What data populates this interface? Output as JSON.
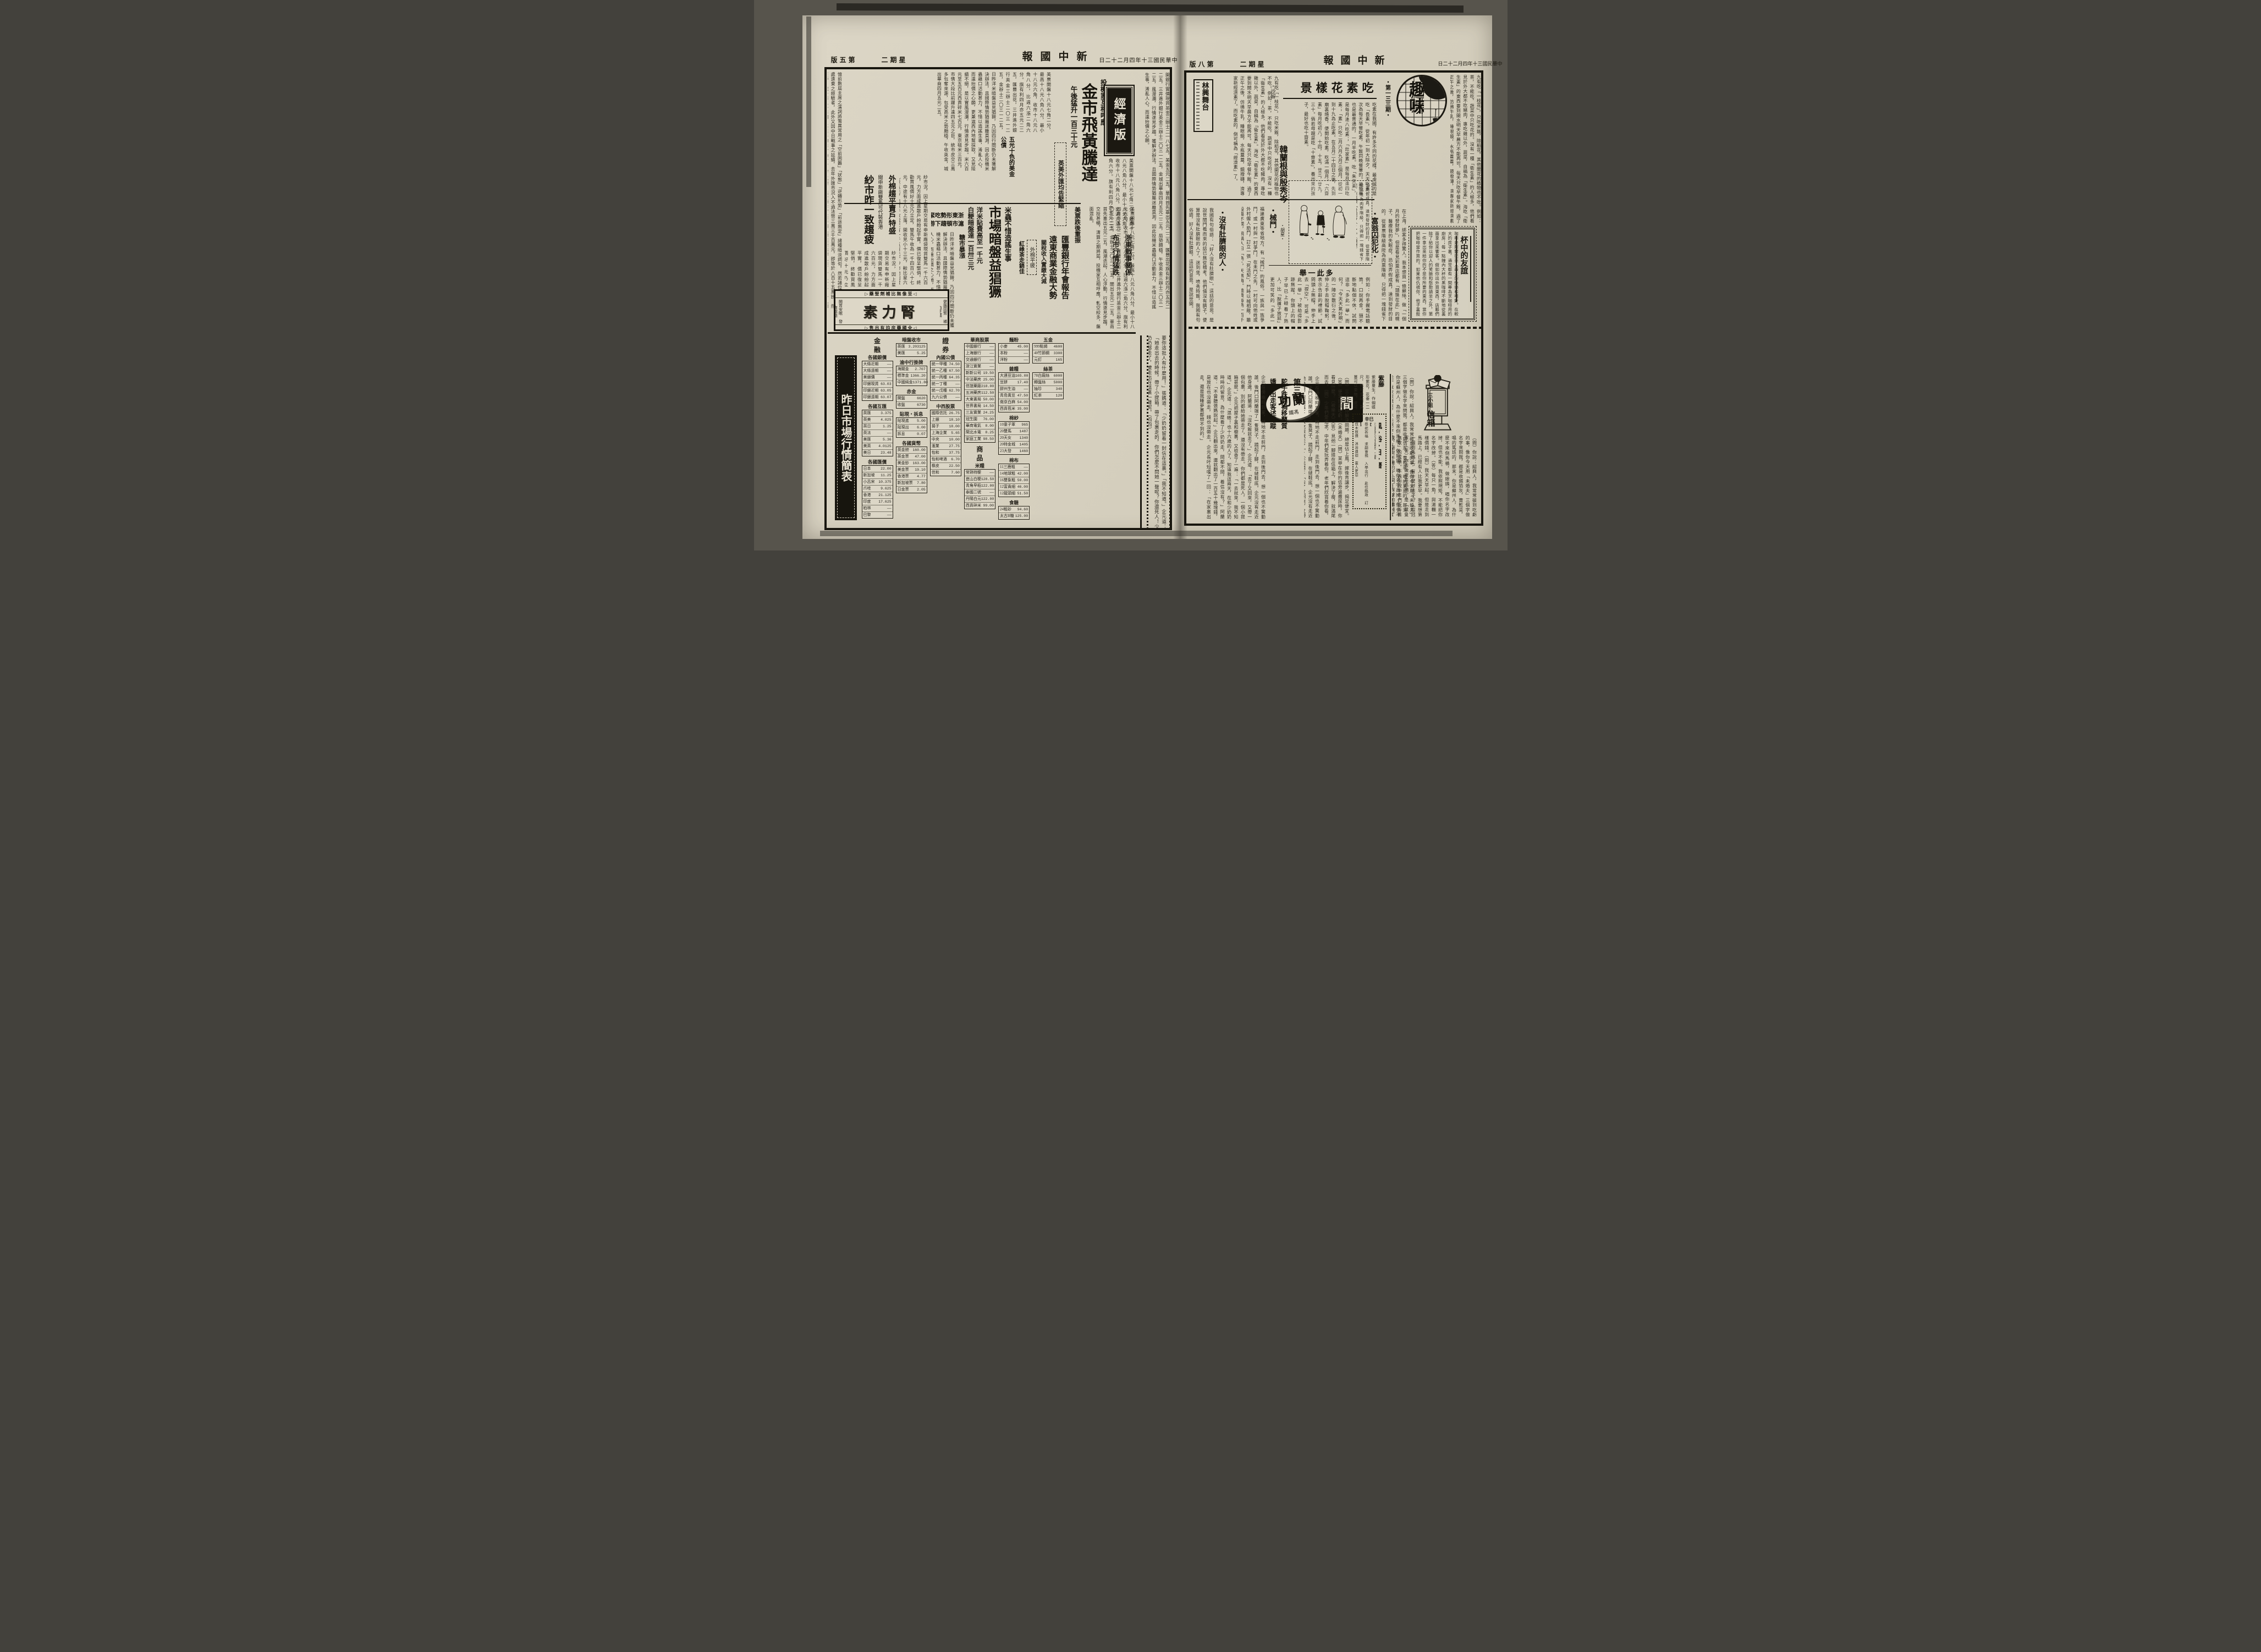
{
  "canvas": {
    "bg": "#57544c",
    "paper": "#d8d2c2",
    "ink": "#1b1810"
  },
  "page5": {
    "header": {
      "page_label": "第五版",
      "weekday": "星期二",
      "masthead": "新中國報",
      "date": "中華民國三十年四月二十二日"
    },
    "seal": "經濟版",
    "lead": {
      "kicker": "投機家互相呼應",
      "headline": "金市飛黃騰達",
      "subhead": "午後猛升一百三十元",
      "fx_box": "英美外匯均告緊縮",
      "war1": "浙東戰事關係",
      "war2": "布市行情猛跌",
      "bonds": "五光十色的美金公債"
    },
    "rice": {
      "kicker": "米蟲不惜造謠生事",
      "headline": "市場暗盤益猖獗",
      "sub1": "洋米貼費高至一千元",
      "sub2": "白粳暗盤達一百卅三元",
      "us": "美票跌後重振",
      "zj1": "浙東形勢吃緊",
      "zj2": "滬市頓趨下游",
      "sugar": "糖市暴漲"
    },
    "hsbc": {
      "l1": "匯豐銀行年會報告",
      "l2": "遠東商業金融大勢",
      "tariff": "關稅收入實繳大減",
      "cotton_flat": "外棉平疲",
      "tea": "紅綠茶走銷佳",
      "yarn_kicker": "聞申新廠雙馬可代裝香港",
      "yarn": "紗市昨一致趨疲",
      "cotton2": "外棉趨平賣戶特盛"
    },
    "body": {
      "a": "日昨洋米暗盤益見猖獗，乃因四行間斷仍未獲解決辦法，且國際情勢猶屬迷離莫測，因此投機米蟲藉口活動甚力，不惜以造謠生事，淆亂人心，而達抬價之心願，更兼滬西內地幫採取，又見陸續不絕，是以實風漫瀰，行情遂見步趨。米六百元至五百元西貢碎米七百元，東京砠米三百元，市情大段比前躍升達四五元之巨，統市皮交三萬多包奪來源，包受高米之勢頗穩，午收英金，城出華商四月五元二五。",
      "b": "美票開盤十八元七角二分，最高十八元八角八分，最小十八元六角，收市十八元八角八分，比週六漲二角六分。旗有利四月亦五元二二五，匯豐出花，三井進外銀行英金三辦士二〇三一二五，金辦士二〇三一二五，開出五元二二五，華商首先塞出五元二五，風潮迭起，人心浮動，行情逐見步趨，交投甚暢，清算之期將屆，投機家互相呼應，軋空絞多，盤面混亂。",
      "c": "憶前數屆主席之演詞將鷩異常用之「空前困難」「狀態」「逆轉形勢」「前途無定」諸種暗淡詞句，然若諸位有數年居處遠東之經驗者，此外又因中日戰事之延續，去年外匯市況入不過法幣三萬三千百萬元，卽等於八百十五萬鎊，然在中日戰爭前之十年間，每年平均未少過一千九百萬鎊，無從轉好。該年輸入總值僅佔總入口百分之一三，一九四〇年竟增至百分之五一，在出口方面又被「專利權」「統制法令」所影響，遂致對於貿易平衡，發生嚴重之後果。",
      "d": "開銀行實價現貨英金三辦士二一八七五，美金五元二五，華商首先塞出五元二二五，匯豐出花旗有利四月亦五元二二五，三井進外銀行英金三辦士二〇三一二五，金城出華商四月五元二二五，局勢頗穩，午收英金三辦士二〇三一二五，風漫瀰，行情遂見步趨。獲解決辦法，且國際情勢猶屬迷離莫測，因此投機米蟲藉口活動甚力，不惜以造謠生事，淆亂人心，而達抬價之心願。",
      "e": "紗市況，因上星期交易有申新廠袋現貨雙馬一千六百元，力方面成進散戶紛紛起平實，價已復呈堅俏，終勸買風價好十元乃立定，雙馬午收為一千四百八十七元，中途有十八元上落，開收見小十三元，較比星六軋跌五元，結果午收成交有一千五百元。紗市始因賣戶匯價乃步落，一時供千六百包，港幫進九百十包，及星六場外計九千二百〇五包，內裝往安南一千包，裝去香港一和樺，新廠成交現貨雙四百七十七元，及同業連五千六百九十五包。"
    },
    "banner": "昨日市場行情簡表",
    "ad": {
      "top": "◁至像無比補劑聖藥▷",
      "name": "腎力素",
      "side_r": "健腦固腎 補血生精",
      "side_l": "開胃安眠 發育滋陰",
      "bottom": "◁全國藥房均有出售▷"
    },
    "serial_tail": "要你這批人有什麼用！」張媽道：「少奶奶留着一封信在這裏。」「我不知道。」企元道：「她走出去的時候，帶了小提箱，帶了包裹走的，你們怎麼不問她一聲呢？你還死人！少奶奶都走了，嬤走出在這裏一聲呢。（四四）",
    "tables": [
      {
        "title": "金　融",
        "sub": "各國銀價",
        "rows": [
          [
            "大條近期",
            "——"
          ],
          [
            "大條遠期",
            "——"
          ],
          [
            "美銀價",
            "——"
          ],
          [
            "印銀現貨",
            "63.03"
          ],
          [
            "印銀近期",
            "63.05"
          ],
          [
            "印銀遠期",
            "63.07"
          ]
        ]
      },
      {
        "sub": "各國互匯",
        "rows": [
          [
            "英匯",
            "3.375"
          ],
          [
            "英美",
            "4.025"
          ],
          [
            "英日",
            "1.25"
          ],
          [
            "英法",
            "——"
          ],
          [
            "美匯",
            "5.36"
          ],
          [
            "美英",
            "4.0125"
          ],
          [
            "美日",
            "23.48"
          ]
        ]
      },
      {
        "sub": "各國匯價",
        "rows": [
          [
            "日本",
            "22.00"
          ],
          [
            "新加坡",
            "11.25"
          ],
          [
            "小呂宋",
            "10.375"
          ],
          [
            "爪哇",
            "9.625"
          ],
          [
            "香港",
            "21.125"
          ],
          [
            "印度",
            "17.625"
          ],
          [
            "柏林",
            "——"
          ],
          [
            "巴黎",
            "——"
          ]
        ]
      },
      {
        "sub": "暗盤收市",
        "rows": [
          [
            "英匯",
            "3.203125"
          ],
          [
            "美匯",
            "5.25"
          ]
        ]
      },
      {
        "sub": "渝中行掛牌",
        "rows": [
          [
            "海關金",
            "2.707"
          ],
          [
            "標準金",
            "1366.20"
          ],
          [
            "中國純金",
            "1371.80"
          ]
        ]
      },
      {
        "sub": "赤金",
        "rows": [
          [
            "開盤",
            "6620"
          ],
          [
            "收盤",
            "6730"
          ]
        ]
      },
      {
        "sub": "貼現・拆息",
        "rows": [
          [
            "貼現進",
            "5.00"
          ],
          [
            "貼現出",
            "6.00"
          ],
          [
            "拆息",
            "0.07"
          ]
        ]
      },
      {
        "sub": "各國貨幣",
        "rows": [
          [
            "英金鎊",
            "160.00"
          ],
          [
            "英金票",
            "47.00"
          ],
          [
            "美金鈔",
            "163.00"
          ],
          [
            "美金票",
            "19.10"
          ],
          [
            "香港票",
            "4.77"
          ],
          [
            "新加坡票",
            "7.80"
          ],
          [
            "日金票",
            "2.05"
          ]
        ]
      },
      {
        "title": "證　券",
        "sub": "內國公債",
        "rows": [
          [
            "統一甲種",
            "74.50"
          ],
          [
            "統一乙種",
            "67.50"
          ],
          [
            "統一丙種",
            "64.35"
          ],
          [
            "統一丁種",
            "——"
          ],
          [
            "統一戊種",
            "62.70"
          ],
          [
            "九六公債",
            "——"
          ]
        ]
      },
      {
        "sub": "中西股票",
        "rows": [
          [
            "國際信託",
            "26.75"
          ],
          [
            "上銀",
            "18.10"
          ],
          [
            "揚子",
            "18.00"
          ],
          [
            "上海企業",
            "5.65"
          ],
          [
            "中央",
            "10.00"
          ],
          [
            "滙業",
            "27.75"
          ],
          [
            "怡和",
            "37.75"
          ],
          [
            "怡和啤酒",
            "6.70"
          ],
          [
            "橡皮",
            "22.50"
          ],
          [
            "信和",
            "7.60"
          ]
        ]
      },
      {
        "sub": "華商股票",
        "rows": [
          [
            "中國銀行",
            "——"
          ],
          [
            "上海銀行",
            "——"
          ],
          [
            "交通銀行",
            "——"
          ],
          [
            "浙江實業",
            "——"
          ],
          [
            "新新公司",
            "19.50"
          ],
          [
            "中法藥房",
            "25.00"
          ],
          [
            "信誼藥廠",
            "218.00"
          ],
          [
            "五洲藥房",
            "112.50"
          ],
          [
            "大東書局",
            "50.00"
          ],
          [
            "世界書局",
            "14.50"
          ],
          [
            "三友實業",
            "24.25"
          ],
          [
            "冠生園",
            "76.00"
          ],
          [
            "華商電氣",
            "8.00"
          ],
          [
            "閘北水電",
            "8.25"
          ],
          [
            "家庭工業",
            "98.50"
          ]
        ]
      },
      {
        "title": "商　品",
        "sub": "米糧",
        "rows": [
          [
            "常熟特粳",
            "——"
          ],
          [
            "崑山白粳",
            "128.50"
          ],
          [
            "青角早稻",
            "122.00"
          ],
          [
            "泰國二號",
            "——"
          ],
          [
            "丹陽白元",
            "122.00"
          ],
          [
            "西貢碎米",
            "99.00"
          ]
        ]
      },
      {
        "sub": "麵粉",
        "rows": [
          [
            "小麥",
            "45.00"
          ],
          [
            "本粉",
            "——"
          ],
          [
            "洋粉",
            "——"
          ]
        ]
      },
      {
        "sub": "雜糧",
        "rows": [
          [
            "大連豆油",
            "165.00"
          ],
          [
            "豆餅",
            "17.40"
          ],
          [
            "膠州生油",
            "——"
          ],
          [
            "青島黃豆",
            "47.50"
          ],
          [
            "南京白麻",
            "54.00"
          ],
          [
            "西貢苞米",
            "35.00"
          ]
        ]
      },
      {
        "sub": "棉紗",
        "rows": [
          [
            "10童子軍",
            "965"
          ],
          [
            "20雙馬",
            "1487"
          ],
          [
            "20天女",
            "1340"
          ],
          [
            "20特金城",
            "1405"
          ],
          [
            "23大發",
            "1460"
          ]
        ]
      },
      {
        "sub": "棉布",
        "rows": [
          [
            "11三鹿粗",
            "——"
          ],
          [
            "14地球粗",
            "42.00"
          ],
          [
            "16雙象粗",
            "50.00"
          ],
          [
            "12富貴細",
            "46.00"
          ],
          [
            "12龍頭細",
            "51.50"
          ]
        ]
      },
      {
        "sub": "食糖",
        "rows": [
          [
            "24粗砂",
            "94.60"
          ],
          [
            "太古B糖",
            "125.00"
          ]
        ]
      },
      {
        "sub": "五金",
        "rows": [
          [
            "999點錫",
            "4600"
          ],
          [
            "40竹節鋼",
            "3300"
          ],
          [
            "元釘",
            "165"
          ]
        ]
      },
      {
        "sub": "絲茶",
        "rows": [
          [
            "78白廠絲",
            "6000"
          ],
          [
            "轉盤絲",
            "5000"
          ],
          [
            "抽珍",
            "340"
          ],
          [
            "紅茶",
            "120"
          ]
        ]
      }
    ]
  },
  "page8": {
    "header": {
      "page_label": "第八版",
      "weekday": "星期二",
      "masthead": "新中國報",
      "date": "中華民國三十年四月二十二日"
    },
    "logo": {
      "name": "趣味",
      "issue": "・第一三三期・"
    },
    "veg": {
      "title": "吃素花樣景",
      "byline": "・沙留"
    },
    "theater": "林興舞台",
    "cartoon": {
      "title": "韓蘭根與殷秀岑",
      "byline": "・胡星・",
      "caption": "怕弄假成真，達到發財的目的，從當票階級高陞為肉票階級，只得把一塊錢省下來，依舊做「丹陽客人」了。（飛瀑）"
    },
    "articles": {
      "fuweng_title": "・富翁囚犯化・",
      "fuweng": "在上海，綁案多得驚人。我本想買一條蘇絲，做「一個月的發財夢」，但是看見彩票店都有「頭獎在此」的幌子，醫療我的失眠症，恐怕弄假成真，達到發財的目的，從當票階級高陞為肉票階級，只得把一塊錢省下來，依舊做「丹陽客人」了。",
      "coffee_title": "杯中的友誼",
      "coffee": "咖啡是阿爾巴亞人最大的快樂和嗜好。在較大的房子裏，通常都有一間專為烹咖啡用的廚房；每一點鐘內大杯的黑咖啡不斷地從裏面拿出來饗客。假如你出外買東西，店夥們除了給你以迎人的笑臉和慇懃請坐之外，第一件拿出來給你的不是你所要的東西，當你把咖啡當作買的。如果他仇視你，他子裏殺死你遠，亦不是他逮。",
      "xiedou_title": "・械鬥・",
      "xiedou": "福建廣東等省地方，有「械鬥」的風俗。一族與一族爭鬥，或一村與一村爭鬥。在未鬥之先，一村可向他姓或外村僱人助鬥，訂立一張「死活契」，鬥時以械相敵，雖殺傷不憫，飛稱人曰「鳥」，天無悔。恤費每鳥一百千文，如鳥糧每隻百文，「某某承雇甚衆」。",
      "duqi_title": "・沒有肚臍眼的人・",
      "duqi": "我國有句俗語：「好人沒有肚臍眼」。這話的意思，是說世間門檻而來的話已無從稽考，他們倆沒有臍子，便算是沒有肚臍眼的人了。迷到坐，喷秀時飯，我國有句俗語，好人沒有肚臍眼，這話的意思，是說世間。",
      "duoci_title": "多此一舉",
      "duoci": "例如：你手握電話聽筒，口說再會，頭不斷地點個不休，試問這非「多此一舉」而何？「今天天氣好啊」的一陣空敷衍之後，伸上手去脫帽鞠躬，表示告辭的禮節。試問頭上無帽，伸手上去「捏空」，可是「多此一舉」？被劫得影跡無蹤，你頭上的帽子早已上碰着了熱人，比「脫褲子放屁」更加可笑的「多此一舉」。"
    },
    "serial": {
      "logo": "蘭功",
      "mark": "間",
      "author": "馮鐵",
      "chapter": "第三回",
      "t1": "駝子跌翻禍移蘭質",
      "t2": "嬌娃出走客述萍蹤",
      "text": "企元在傍晚時到家，特地不走前門，走到後門去，想一個也不驚動誰。後門口阿蘭端了一隻凳子，蹺起了腳，在縫鞋底。企元沒有走近他身邊，阿蘭道：「沒吃飯就走了。」企元道：「去了又回來，又帶一個包裹，別的都給她帶走了，還沒有帶走。你們都是死人，一個小提箱甚麼。」企元把屋子裏和櫥裏，又檢查了一遍：「一去就來，我不知道。」企元道：「混帳！也十六歲的人了，知道我這兩天，在和少奶奶時時的留意，為什麼看了少奶奶走，問都不問，着信沒有？」阿蘭道：「不曾聽張媽說起。」企元翻出來，還就翻出了一百五十幾塊錢，是放在也沒帶走，錢也沒帶走。企元長吁短嘆了一回：「在家裏出走，還是我睡夢裏都想不到的。」"
    },
    "qa2": "（問）三小姐，你解決問題，總是佔上風，嫁後肯讓步，揭足便宜。（答）便宜即是吃虧。（未婚夫）（問）某甲在你的信旁邊撒尿時，你看見什麼？（被樂天）（答）見他一腳搭在信箱上，解決了瘦，就滿尾而去。（問）少年們愛追求，中年們愛玩弄着你，老年們欣賞着你看，這是什麼道理？（一語道破山人）（答）這樣，故稱「亂刀斬」。",
    "mailbox": {
      "t1": "三小姐",
      "t2": "信箱",
      "qa": "（問）你說：紹興人，我常常碰到吃虧的事，像你今天用「未婚夫」三個字做名字來問我，都是收錫箔灰，賣乾菜，唱的篤班的，那末，你是蘇州人，為什麼不來倒馬桶，做娘姨，唱你名字改掉，但也不能。我依照規矩，不能把你名字改掉。（答）每只一角，與湯糰一樣價錢。（問）我天天早起，但是走到馬路上，已經有人比我更早。我要想第一個到馬路上，有什麼好法子？（程冠軍）（答）你去做夜差巡捕。是「童叟無欺」的成績。不過你說中年們玩弄着我，絕對不確的。（問）踩球的價錢，你看至多漲到多少？（燒火喇叭）"
    },
    "almanac": {
      "ganzhi": "辛巳",
      "title": "風・俗・日・曆",
      "date": "三月廿六日庚子土曜",
      "yi_label": "宜",
      "yi": "祭祀祈福 求嗣會親 入學出行 赴任臨政 訂婚納采 嫁娶解除 治病裁衣 修造動土 豎柱上樑 開市交易",
      "ji_label": "忌",
      "ji": "伐木放債 沐浴遠迴 東人更忌",
      "note_title": "紫藤",
      "note": "紫藤蔓生，作蝴蝶形紫花，花垂一二尺，殊可愛玩。其蔓可以束物，皮可製絲樣布。"
    },
    "body": {
      "a": "吃素在我國，有許多不同的花樣，最虔誠的是吃「長素」，從年初一到大除夕，天天吃素。次為每天早餐吃素，午飯同晚餐葷的。最簡單也是最普通的，一月半吃素。吃「朱天素」，是每月逢八吃素；「灶家素」是每月逢四吃素；「素」只吃二月六月九月三個月，從初一到十九為止吃素。在五月二十四日之後，先到廟裏燒香，便開始吃素，吃滿一個月。「六齋素」每月吃初八，十四，十五，廿三，廿九，三十。倘若母親是吃「十齋素」，養出來的孩子，最好也吃十齋素。",
      "b": "九有吃「一枝花」，只吃米飯，除稻花，其他開花的植物也不吃。例如：茶，不能吃，蔬菜中只吃花的。沒有一種「衛生素」的人極多，他們看見於外大都不吃豬肉，專吃雞以外，蔬菜，自稱為「衛生素」。海吃「衛生素」的東西要到開水明天早晨方不能再可。每天只吃早餐午飯，過了正午之後，仿彿牛乳，睡眼鏡，水瓶蓋蓋，鏡撥磚，濟專家新經濟素了。而吃素的，倒可稱為「經濟素」了。"
    }
  }
}
